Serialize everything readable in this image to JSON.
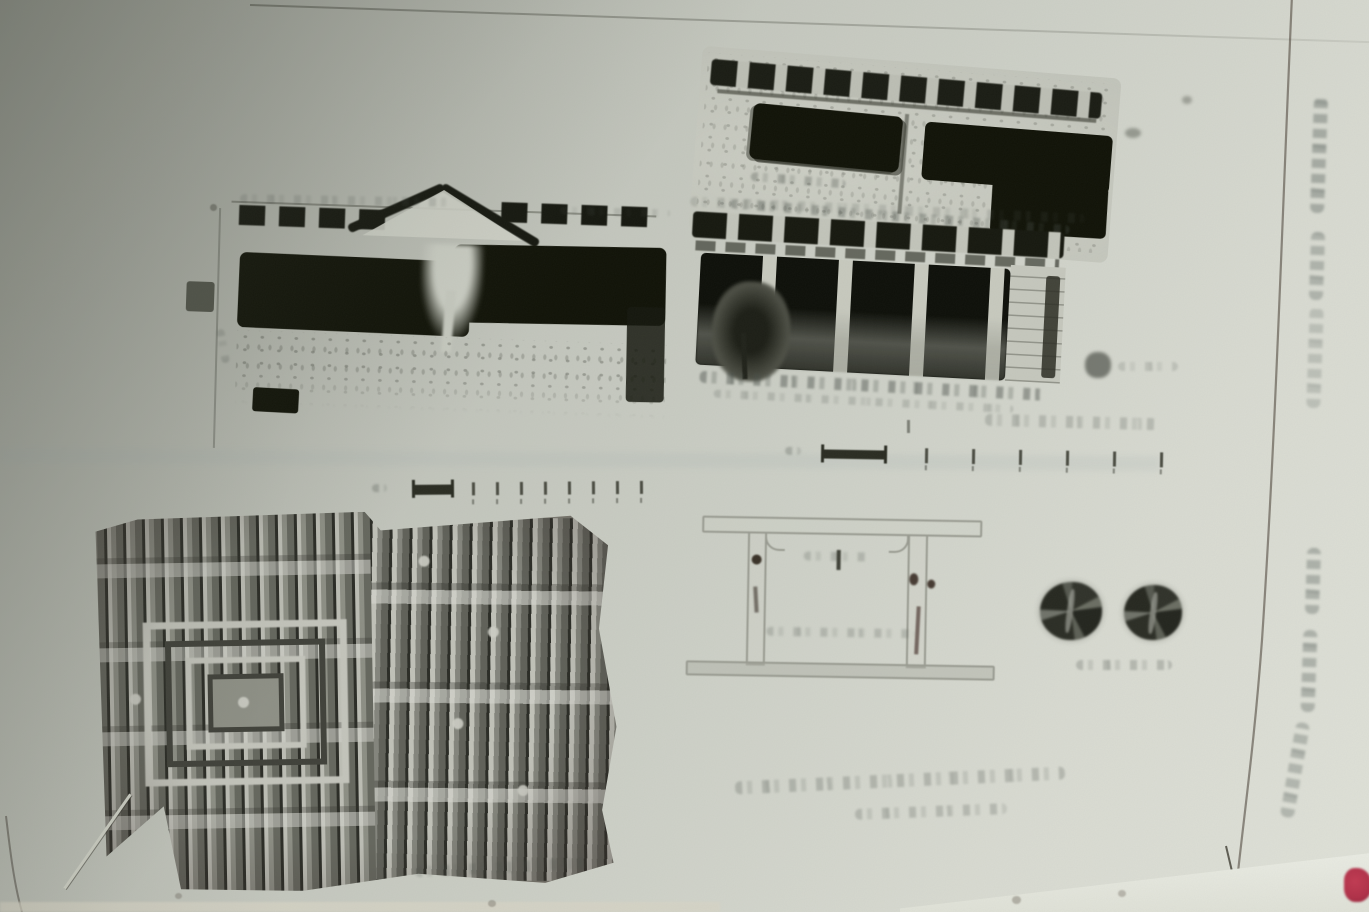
{
  "palette": {
    "page_shadow": "#a2a59c",
    "page_mid": "#c6c9c0",
    "page_light": "#dcded5",
    "fore_edge": "#eceee6",
    "ink_black": "#101207",
    "ink_gray": "#4c4e44",
    "faint_ink": "#8b8d83",
    "photo_light": "#c9cabf",
    "photo_dark": "#2c2e25",
    "red_mark": "#b13048"
  },
  "figures": {
    "top_right_photo": {
      "icon": "building-facade-photo"
    },
    "middle_left_drawing": {
      "icon": "building-section-drawing"
    },
    "middle_right_drawing": {
      "icon": "portico-elevation-photo"
    },
    "ceiling_photo": {
      "icon": "coffered-wood-ceiling-photo"
    },
    "portal_drawing": {
      "icon": "door-frame-line-drawing"
    },
    "rosettes": {
      "icon": "carved-roundel-pair",
      "count": 2
    }
  },
  "scalebars": {
    "right": {
      "tick_count": 6
    },
    "left": {
      "tick_count": 8
    }
  },
  "margin_text": {
    "segment_count": 6,
    "orientation": "vertical",
    "legible": false
  },
  "captions": {
    "bottom_right": {
      "line_count": 2,
      "legible": false
    },
    "under_ceiling": {
      "line_count": 1,
      "legible": false
    },
    "under_rosettes": {
      "line_count": 1,
      "legible": false
    },
    "above_right_scalebar": {
      "line_count": 1,
      "legible": false
    }
  }
}
